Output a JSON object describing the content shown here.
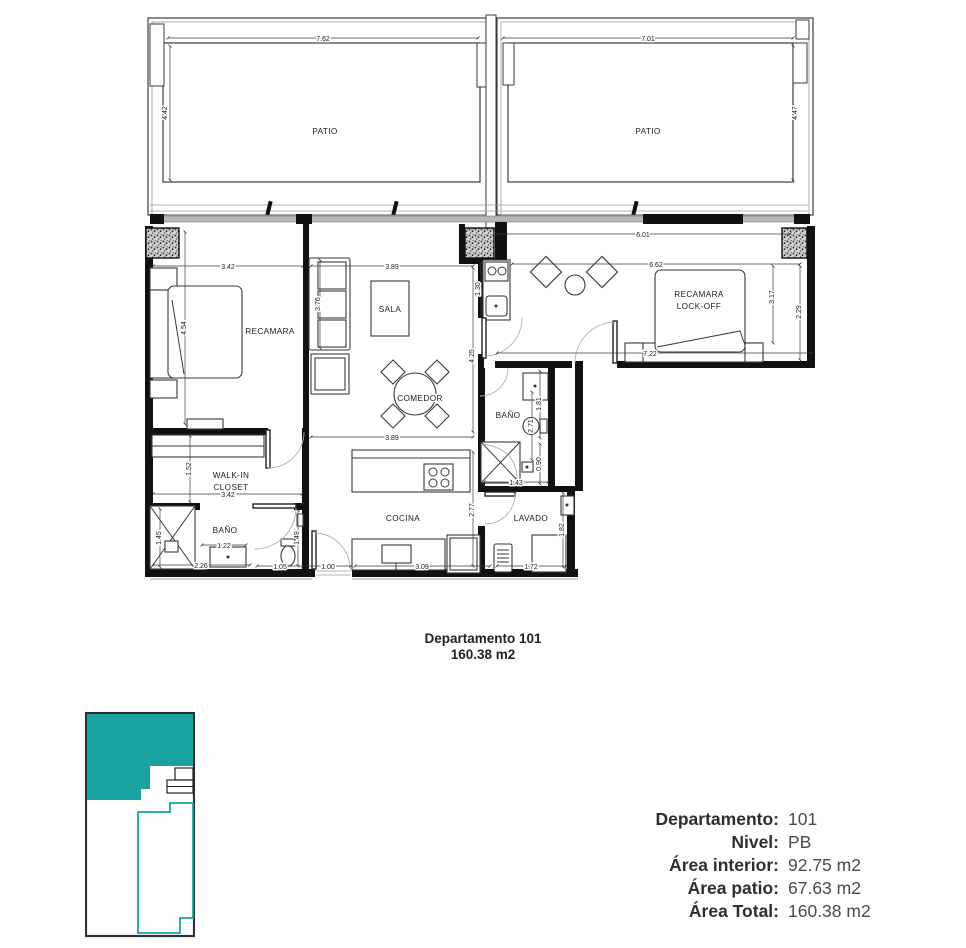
{
  "plan": {
    "rooms": {
      "patio_left": "PATIO",
      "patio_right": "PATIO",
      "recamara": "RECAMARA",
      "sala": "SALA",
      "comedor": "COMEDOR",
      "lockoff_line1": "RECAMARA",
      "lockoff_line2": "LOCK-OFF",
      "bano_lockoff": "BAÑO",
      "walkin_line1": "WALK-IN",
      "walkin_line2": "CLOSET",
      "bano_master": "BAÑO",
      "cocina": "COCINA",
      "lavado": "LAVADO"
    },
    "dims": {
      "patio_left_w": "7.62",
      "patio_left_d": "4.42",
      "patio_right_w": "7.01",
      "patio_right_d": "4.47",
      "recamara_w": "3.42",
      "recamara_d": "4.54",
      "sala_w": "3.89",
      "sofa_len": "3.76",
      "wing_w": "6.01",
      "lockoff_w": "6.62",
      "lockoff_d": "3.17",
      "lockoff_win": "2.29",
      "wing_total": "7.22",
      "kitchenette": "1.30",
      "living_d": "4.25",
      "comedor_w": "3.89",
      "bano2_vanity": "1.81",
      "bano2_d": "2.71",
      "bano2_shower_w": "1.43",
      "bano2_shower_d": "0.90",
      "closet_d": "1.52",
      "closet_w": "3.42",
      "cocina_d": "2.77",
      "bano1_shower": "1.45",
      "bano1_vanity": "1.22",
      "bano1_d": "1.49",
      "bano1_w": "2.26",
      "bano1_door": "1.05",
      "entry": "1.00",
      "cocina_w": "3.09",
      "lavado_d": "1.82",
      "lavado_w": "1.72"
    }
  },
  "title": {
    "name": "Departamento 101",
    "area": "160.38 m2"
  },
  "summary": {
    "rows": [
      {
        "label": "Departamento:",
        "value": "101"
      },
      {
        "label": "Nivel:",
        "value": "PB"
      },
      {
        "label": "Área interior:",
        "value": "92.75 m2"
      },
      {
        "label": "Área patio:",
        "value": "67.63 m2"
      },
      {
        "label": "Área Total:",
        "value": "160.38 m2"
      }
    ]
  },
  "colors": {
    "accent_teal": "#19a3a0"
  }
}
